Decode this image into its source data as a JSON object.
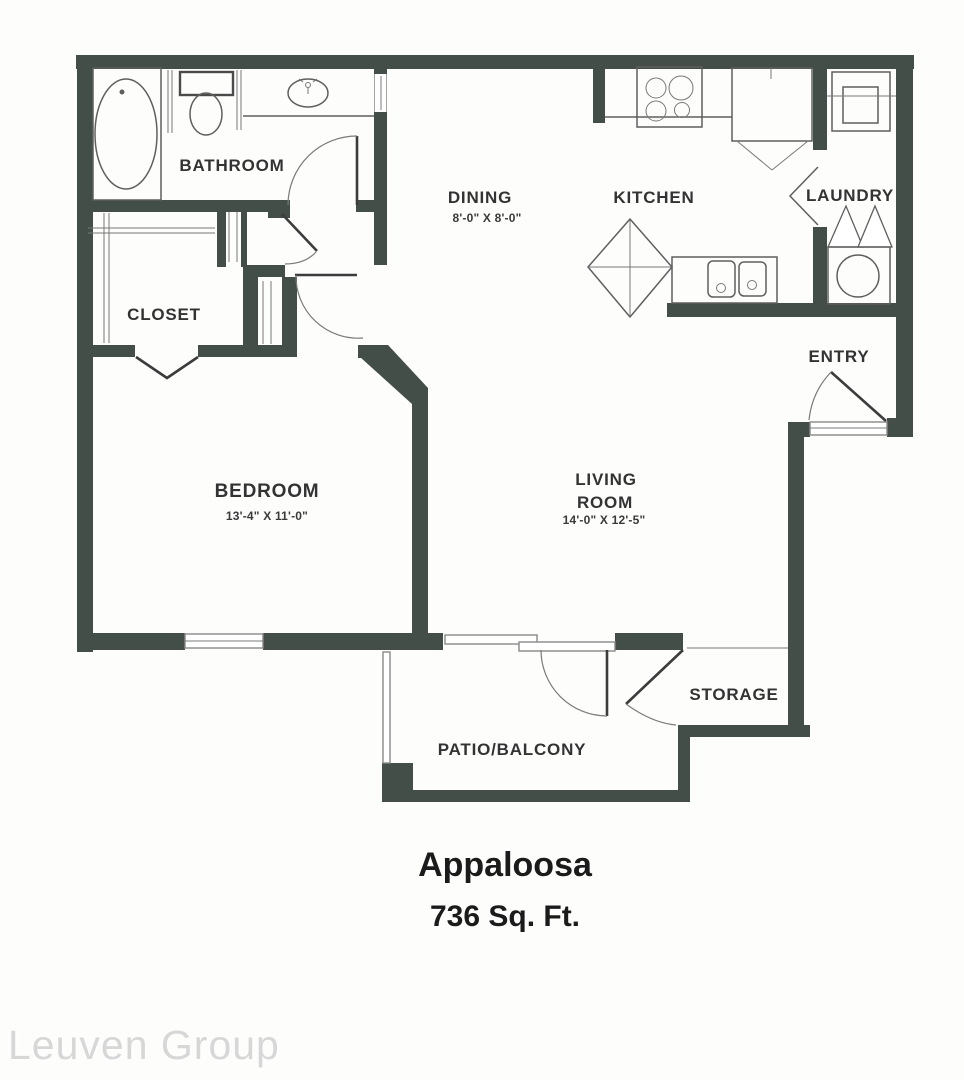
{
  "plan": {
    "title": "Appaloosa",
    "area": "736 Sq. Ft.",
    "watermark": "Leuven Group",
    "colors": {
      "wall": "#424e47",
      "fixture_line": "#5f5f5f",
      "door_leaf": "#3c3c3c",
      "label_text": "#333333",
      "title_text": "#1b1b1b",
      "watermark_text": "#d7d7d7",
      "background": "#fdfdfc"
    },
    "rooms": {
      "bathroom": {
        "label": "BATHROOM"
      },
      "closet": {
        "label": "CLOSET"
      },
      "bedroom": {
        "label": "BEDROOM",
        "dims": "13'-4\" X 11'-0\""
      },
      "dining": {
        "label": "DINING",
        "dims": "8'-0\" X 8'-0\""
      },
      "kitchen": {
        "label": "KITCHEN"
      },
      "laundry": {
        "label": "LAUNDRY"
      },
      "entry": {
        "label": "ENTRY"
      },
      "living": {
        "label_line1": "LIVING",
        "label_line2": "ROOM",
        "dims": "14'-0\" X 12'-5\""
      },
      "storage": {
        "label": "STORAGE"
      },
      "patio": {
        "label": "PATIO/BALCONY"
      }
    }
  }
}
